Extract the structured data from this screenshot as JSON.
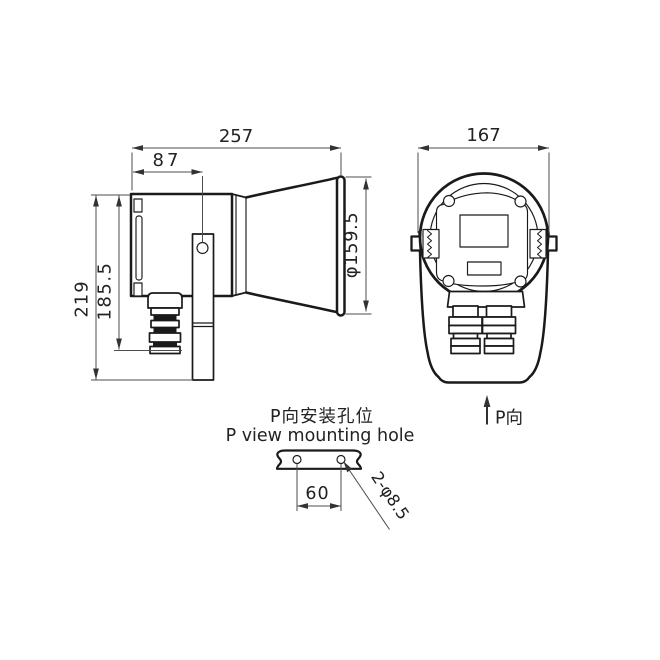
{
  "drawing": {
    "colors": {
      "background": "#ffffff",
      "line": "#1a1a1a",
      "dim": "#4d4d4d",
      "text": "#222222"
    },
    "side_view": {
      "overall_length": "257",
      "bracket_hole_offset": "87",
      "overall_height": "219",
      "body_height": "185.5",
      "horn_diameter": "φ159.5"
    },
    "front_view": {
      "overall_width": "167",
      "direction_label": "P向"
    },
    "mounting_detail": {
      "title_zh": "P向安装孔位",
      "title_en": "P view mounting hole",
      "hole_spacing": "60",
      "hole_spec": "2-φ8.5"
    }
  }
}
